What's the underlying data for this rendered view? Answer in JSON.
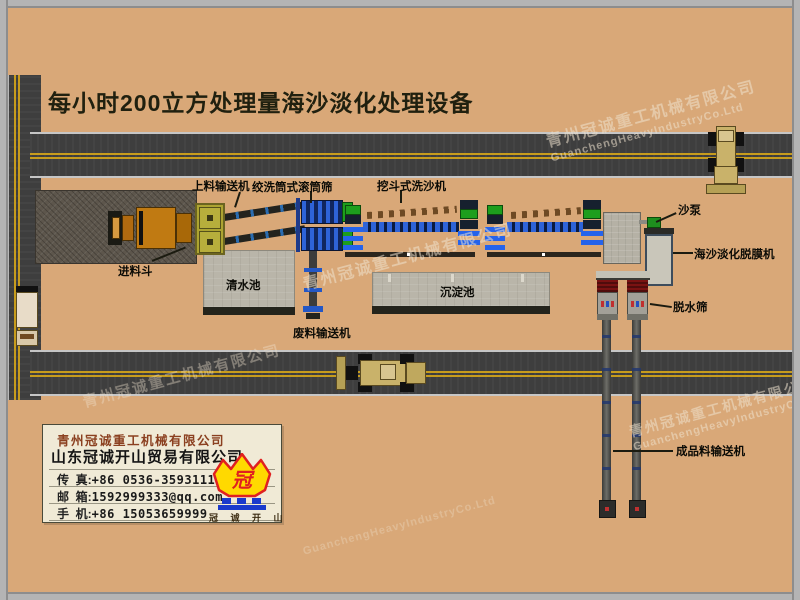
{
  "title": "每小时200立方处理量海沙淡化处理设备",
  "labels": {
    "loading_conveyor": "上料输送机",
    "drum_screen": "绞洗筒式滚筒筛",
    "bucket_washer": "挖斗式洗沙机",
    "feed_hopper": "进料斗",
    "clean_water_pool": "清水池",
    "sedimentation_pool": "沉淀池",
    "waste_conveyor": "废料输送机",
    "sand_pump": "沙泵",
    "desalination_machine": "海沙淡化脱膜机",
    "dewatering_screen": "脱水筛",
    "product_conveyor": "成品料输送机"
  },
  "company_box": {
    "company_primary": "青州冠诚重工机械有限公司",
    "company_secondary": "山东冠诚开山贸易有限公司",
    "colon": ":",
    "contacts": [
      {
        "label": "传  真",
        "value": "+86 0536-3593111"
      },
      {
        "label": "邮  箱",
        "value": "1592999333@qq.com"
      },
      {
        "label": "手  机",
        "value": "+86 15053659999"
      }
    ],
    "logo_glyph": "冠",
    "logo_caption": "冠 诚 开 山"
  },
  "watermarks": {
    "cn": "青州冠诚重工机械有限公司",
    "en": "GuanchengHeavyIndustryCo.Ltd"
  },
  "colors": {
    "background": "#d9a878",
    "road_asphalt": "#3e3e3e",
    "lane_yellow": "#c79c1d",
    "machine_blue": "#2e63d8",
    "machine_green": "#1d9e1d",
    "pool_gray": "#b9b5a9",
    "screen_red": "#7a1212",
    "logo_yellow": "#ffd900",
    "logo_red": "#e02020",
    "logo_blue": "#1a3acc",
    "title_text": "#20200f"
  }
}
